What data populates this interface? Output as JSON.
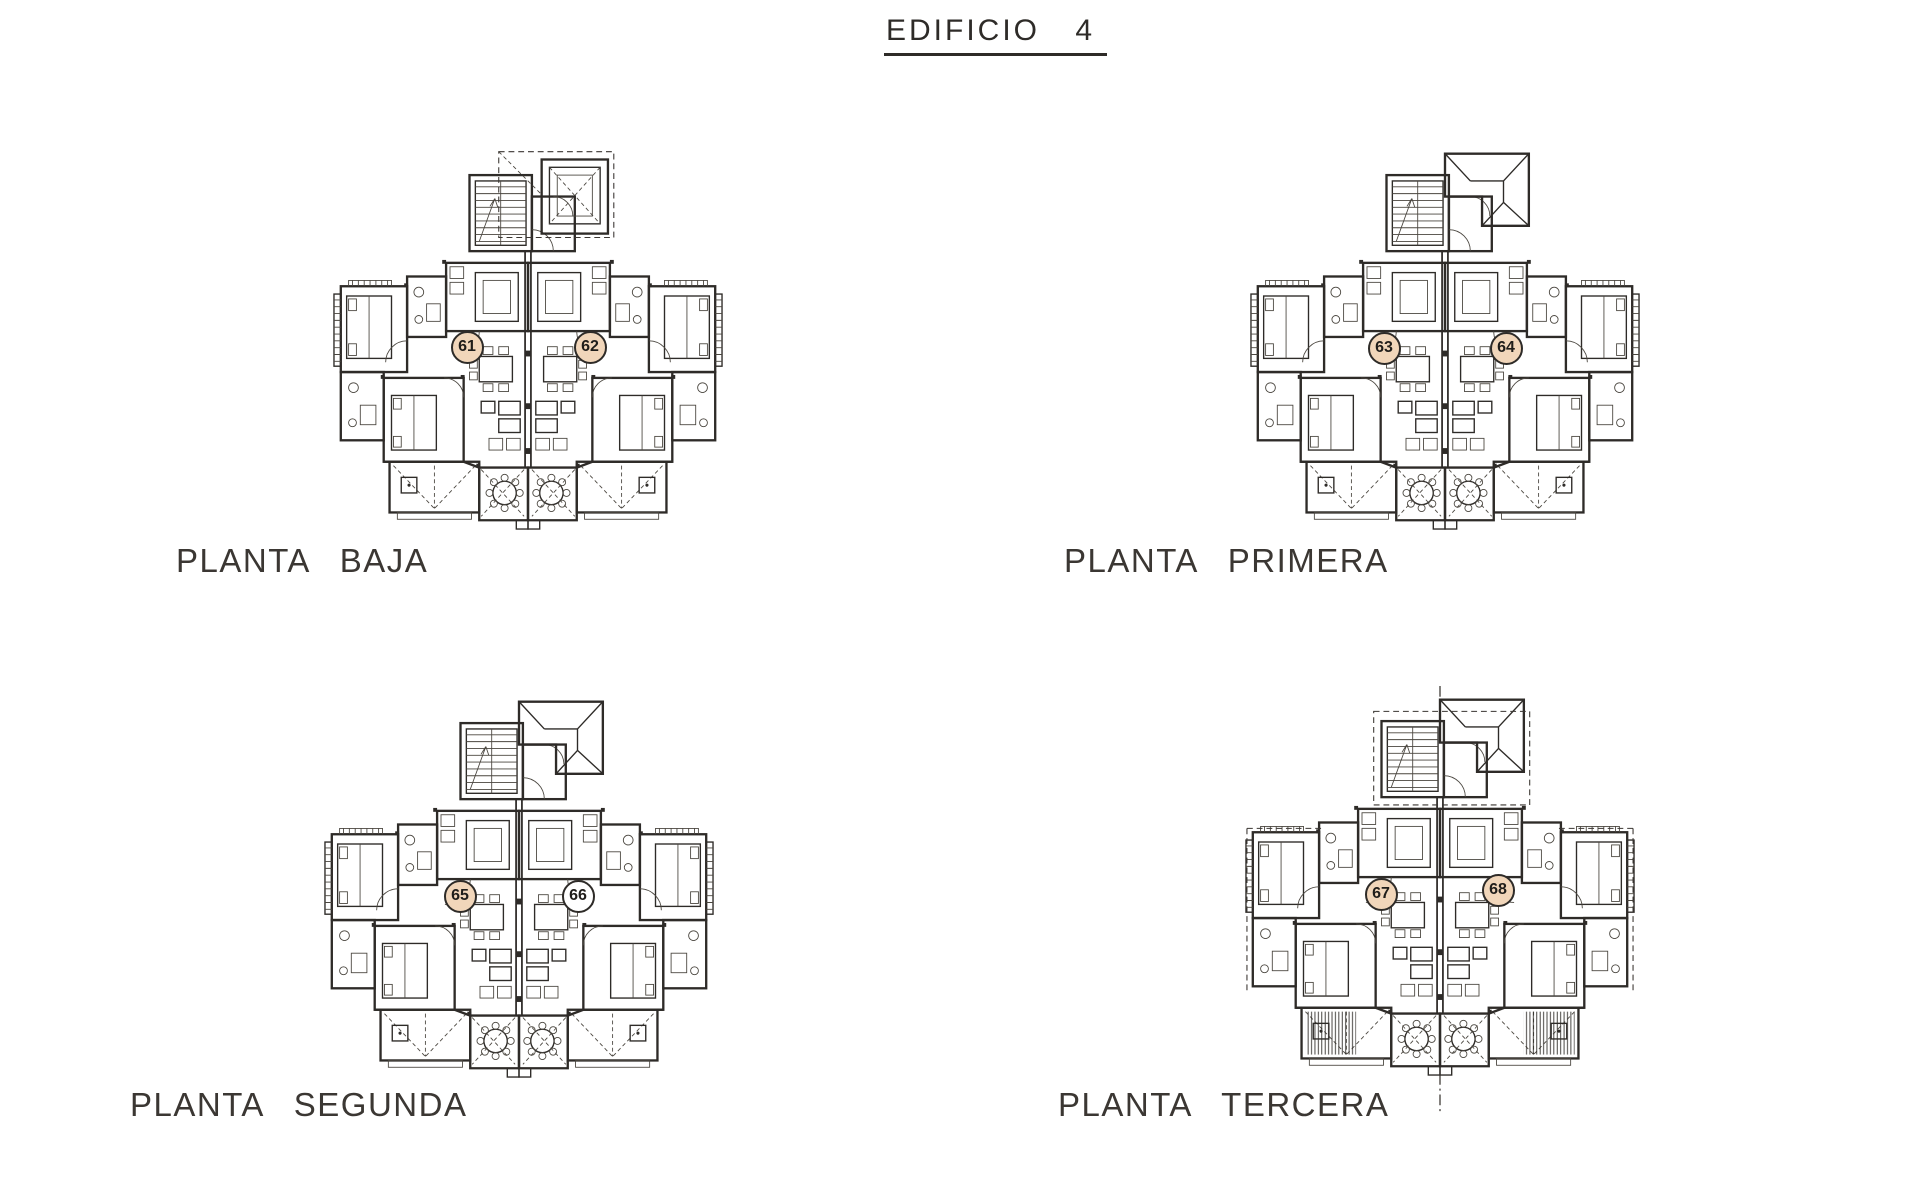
{
  "sheet": {
    "title": "EDIFICIO 4",
    "type_note": "architectural floor-plan sheet with four plans"
  },
  "colors": {
    "paper": "#ffffff",
    "line": "#2e2b28",
    "badge-fill": "#f1d6ba",
    "badge-empty": "#ffffff"
  },
  "plans": [
    {
      "id": "planta-baja",
      "label": "PLANTA BAJA",
      "roof_style": "dashed-outline-room",
      "units": [
        {
          "number": "61",
          "highlighted": true
        },
        {
          "number": "62",
          "highlighted": true
        }
      ]
    },
    {
      "id": "planta-primera",
      "label": "PLANTA PRIMERA",
      "roof_style": "hatched-roof",
      "units": [
        {
          "number": "63",
          "highlighted": true
        },
        {
          "number": "64",
          "highlighted": true
        }
      ]
    },
    {
      "id": "planta-segunda",
      "label": "PLANTA SEGUNDA",
      "roof_style": "hatched-roof",
      "units": [
        {
          "number": "65",
          "highlighted": true
        },
        {
          "number": "66",
          "highlighted": false
        }
      ]
    },
    {
      "id": "planta-tercera",
      "label": "PLANTA TERCERA",
      "roof_style": "hatched-roof-with-dashed-overhang",
      "units": [
        {
          "number": "67",
          "highlighted": true
        },
        {
          "number": "68",
          "highlighted": true
        }
      ]
    }
  ]
}
